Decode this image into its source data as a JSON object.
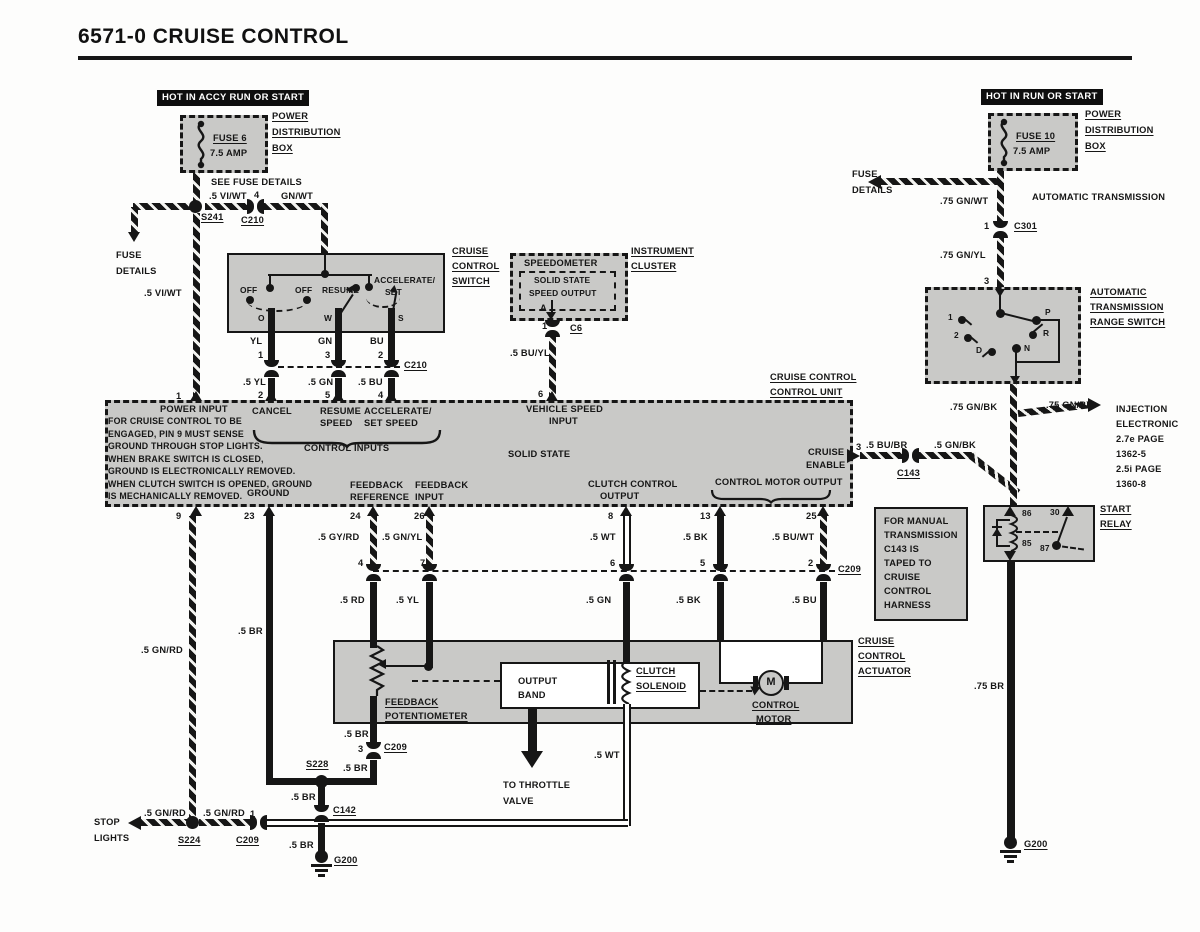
{
  "title": "6571-0  CRUISE CONTROL",
  "colors": {
    "ink": "#161616",
    "box_gray": "#c9c9c7",
    "paper": "#fdfdfc"
  },
  "left_fuse": {
    "hot": "HOT IN ACCY RUN OR START",
    "fuse": "FUSE 6",
    "amp": "7.5 AMP",
    "pd1": "POWER",
    "pd2": "DISTRIBUTION",
    "pd3": "BOX",
    "see": "SEE FUSE DETAILS",
    "viwt1": ".5 VI/WT",
    "p4": "4",
    "gnwt": "GN/WT",
    "s241": "S241",
    "c210": "C210",
    "fd1": "FUSE",
    "fd2": "DETAILS",
    "viwt2": ".5 VI/WT",
    "p1": "1"
  },
  "switch": {
    "off1": "OFF",
    "off2": "OFF",
    "resume": "RESUME",
    "acc1": "ACCELERATE/",
    "acc2": "SET",
    "to": "O",
    "tw": "W",
    "ts": "S",
    "n1": "CRUISE",
    "n2": "CONTROL",
    "n3": "SWITCH",
    "yl": "YL",
    "p1": "1",
    "gn": "GN",
    "p3": "3",
    "bu": "BU",
    "p2": "2",
    "c210": "C210",
    "yl5": ".5 YL",
    "p2b": "2",
    "gn5": ".5 GN",
    "p5b": "5",
    "bu5": ".5 BU",
    "p4b": "4"
  },
  "cluster": {
    "speedo": "SPEEDOMETER",
    "ss": "SOLID STATE",
    "so": "SPEED OUTPUT",
    "n1": "INSTRUMENT",
    "n2": "CLUSTER",
    "pa": "A",
    "p1": "1",
    "c6": "C6",
    "buyl": ".5 BU/YL",
    "p6": "6"
  },
  "unit": {
    "n1": "CRUISE CONTROL",
    "n2": "CONTROL UNIT",
    "power": "POWER INPUT",
    "note": [
      "FOR CRUISE CONTROL TO BE",
      "ENGAGED, PIN 9 MUST SENSE",
      "GROUND THROUGH STOP LIGHTS.",
      "WHEN BRAKE SWITCH IS CLOSED,",
      "GROUND IS ELECTRONICALLY REMOVED.",
      "WHEN CLUTCH SWITCH IS OPENED, GROUND",
      "IS MECHANICALLY REMOVED."
    ],
    "cancel": "CANCEL",
    "res1": "RESUME",
    "res2": "SPEED",
    "acc1": "ACCELERATE/",
    "acc2": "SET SPEED",
    "ci": "CONTROL INPUTS",
    "vs1": "VEHICLE SPEED",
    "vs2": "INPUT",
    "ss": "SOLID STATE",
    "ce1": "CRUISE",
    "ce2": "ENABLE",
    "gnd": "GROUND",
    "fr1": "FEEDBACK",
    "fr2": "REFERENCE",
    "fi1": "FEEDBACK",
    "fi2": "INPUT",
    "cc1": "CLUTCH CONTROL",
    "cc2": "OUTPUT",
    "cmo": "CONTROL MOTOR OUTPUT",
    "p9": "9",
    "p23": "23",
    "p24": "24",
    "p26": "26",
    "p8": "8",
    "p13": "13",
    "p25": "25",
    "p3": "3"
  },
  "mid": {
    "gyrd": ".5 GY/RD",
    "gnyl": ".5 GN/YL",
    "p4": "4",
    "p7": "7",
    "rd": ".5 RD",
    "yl": ".5 YL",
    "wt": ".5 WT",
    "bk1": ".5 BK",
    "buwt": ".5 BU/WT",
    "p6": "6",
    "p5": "5",
    "p2": "2",
    "c209": "C209",
    "gn": ".5 GN",
    "bk2": ".5 BK",
    "bu": ".5 BU",
    "gnrd": ".5 GN/RD",
    "br": ".5 BR",
    "bubr": ".5 BU/BR",
    "c143": "C143",
    "gnbk": ".5 GN/BK"
  },
  "act": {
    "n1": "CRUISE",
    "n2": "CONTROL",
    "n3": "ACTUATOR",
    "fp1": "FEEDBACK",
    "fp2": "POTENTIOMETER",
    "ob1": "OUTPUT",
    "ob2": "BAND",
    "cs1": "CLUTCH",
    "cs2": "SOLENOID",
    "cm1": "CONTROL",
    "cm2": "MOTOR",
    "m": "M",
    "wt": ".5 WT",
    "tt1": "TO THROTTLE",
    "tt2": "VALVE"
  },
  "bottom": {
    "br1": ".5 BR",
    "p3": "3",
    "c209a": "C209",
    "s228": "S228",
    "br2": ".5 BR",
    "br3": ".5 BR",
    "c142": "C142",
    "br4": ".5 BR",
    "g200": "G200",
    "stop1": "STOP",
    "stop2": "LIGHTS",
    "gnrd1": ".5 GN/RD",
    "gnrd2": ".5 GN/RD",
    "p1": "1",
    "s224": "S224",
    "c209b": "C209"
  },
  "right": {
    "hot": "HOT IN RUN OR START",
    "fuse": "FUSE 10",
    "amp": "7.5 AMP",
    "pd1": "POWER",
    "pd2": "DISTRIBUTION",
    "pd3": "BOX",
    "fd1": "FUSE",
    "fd2": "DETAILS",
    "gnwt": ".75 GN/WT",
    "at": "AUTOMATIC TRANSMISSION",
    "p1": "1",
    "c301": "C301",
    "gnyl": ".75 GN/YL",
    "p3": "3",
    "rs1": "AUTOMATIC",
    "rs2": "TRANSMISSION",
    "rs3": "RANGE SWITCH",
    "pos1": "1",
    "pos2": "2",
    "posd": "D",
    "posp": "P",
    "posr": "R",
    "posn": "N",
    "gnbk1": ".75 GN/BK",
    "gnbk2": ".75 GN/BK",
    "inj": [
      "INJECTION",
      "ELECTRONIC",
      "2.7e PAGE",
      "1362-5",
      "2.5i PAGE",
      "1360-8"
    ],
    "sr1": "START",
    "sr2": "RELAY",
    "t86": "86",
    "t30": "30",
    "t85": "85",
    "t87": "87",
    "br75": ".75 BR",
    "g200": "G200"
  },
  "note_box": {
    "lines": [
      "FOR MANUAL",
      "TRANSMISSION",
      "C143 IS",
      "TAPED TO",
      "CRUISE",
      "CONTROL",
      "HARNESS"
    ]
  }
}
